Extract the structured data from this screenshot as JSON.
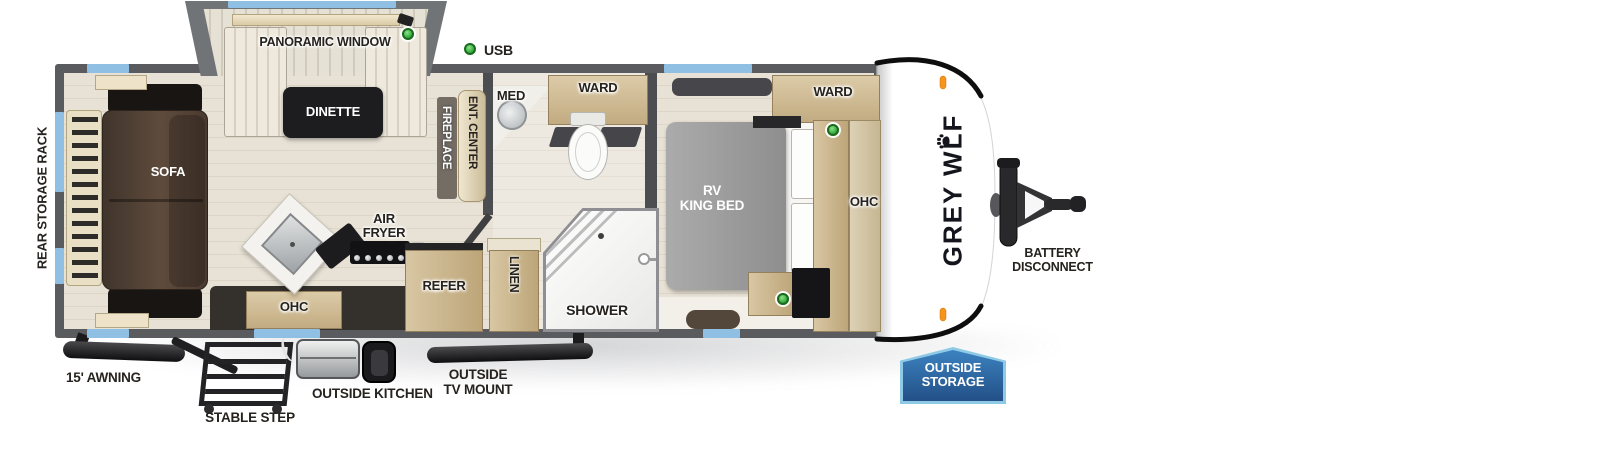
{
  "fp": {
    "brand": "GREY WOLF",
    "legend": {
      "usb": "USB"
    },
    "rooms": {
      "panoramic_window": "PANORAMIC WINDOW",
      "dinette": "DINETTE",
      "sofa": "SOFA",
      "rear_storage_rack": "REAR STORAGE RACK",
      "fireplace": "FIREPLACE",
      "ent_center": "ENT. CENTER",
      "med": "MED",
      "bath_ward": "WARD",
      "air_fryer": "AIR\nFRYER",
      "kitchen_ohc": "OHC",
      "refer": "REFER",
      "linen": "LINEN",
      "shower": "SHOWER",
      "king_bed": "RV\nKING BED",
      "bed_ward": "WARD",
      "bed_ohc": "OHC"
    },
    "exterior": {
      "awning": "15' AWNING",
      "stable_step": "STABLE STEP",
      "outside_kitchen": "OUTSIDE KITCHEN",
      "outside_tv_mount": "OUTSIDE\nTV MOUNT",
      "battery_disconnect": "BATTERY\nDISCONNECT",
      "outside_storage": "OUTSIDE\nSTORAGE"
    },
    "colors": {
      "wall": "#5a5b5e",
      "window_blue": "#8fc0e4",
      "usb_green": "#3cb043",
      "storage_badge_blue": "#2f6ea8",
      "storage_badge_border": "#8ecae6",
      "marker_orange": "#f7941d"
    }
  }
}
